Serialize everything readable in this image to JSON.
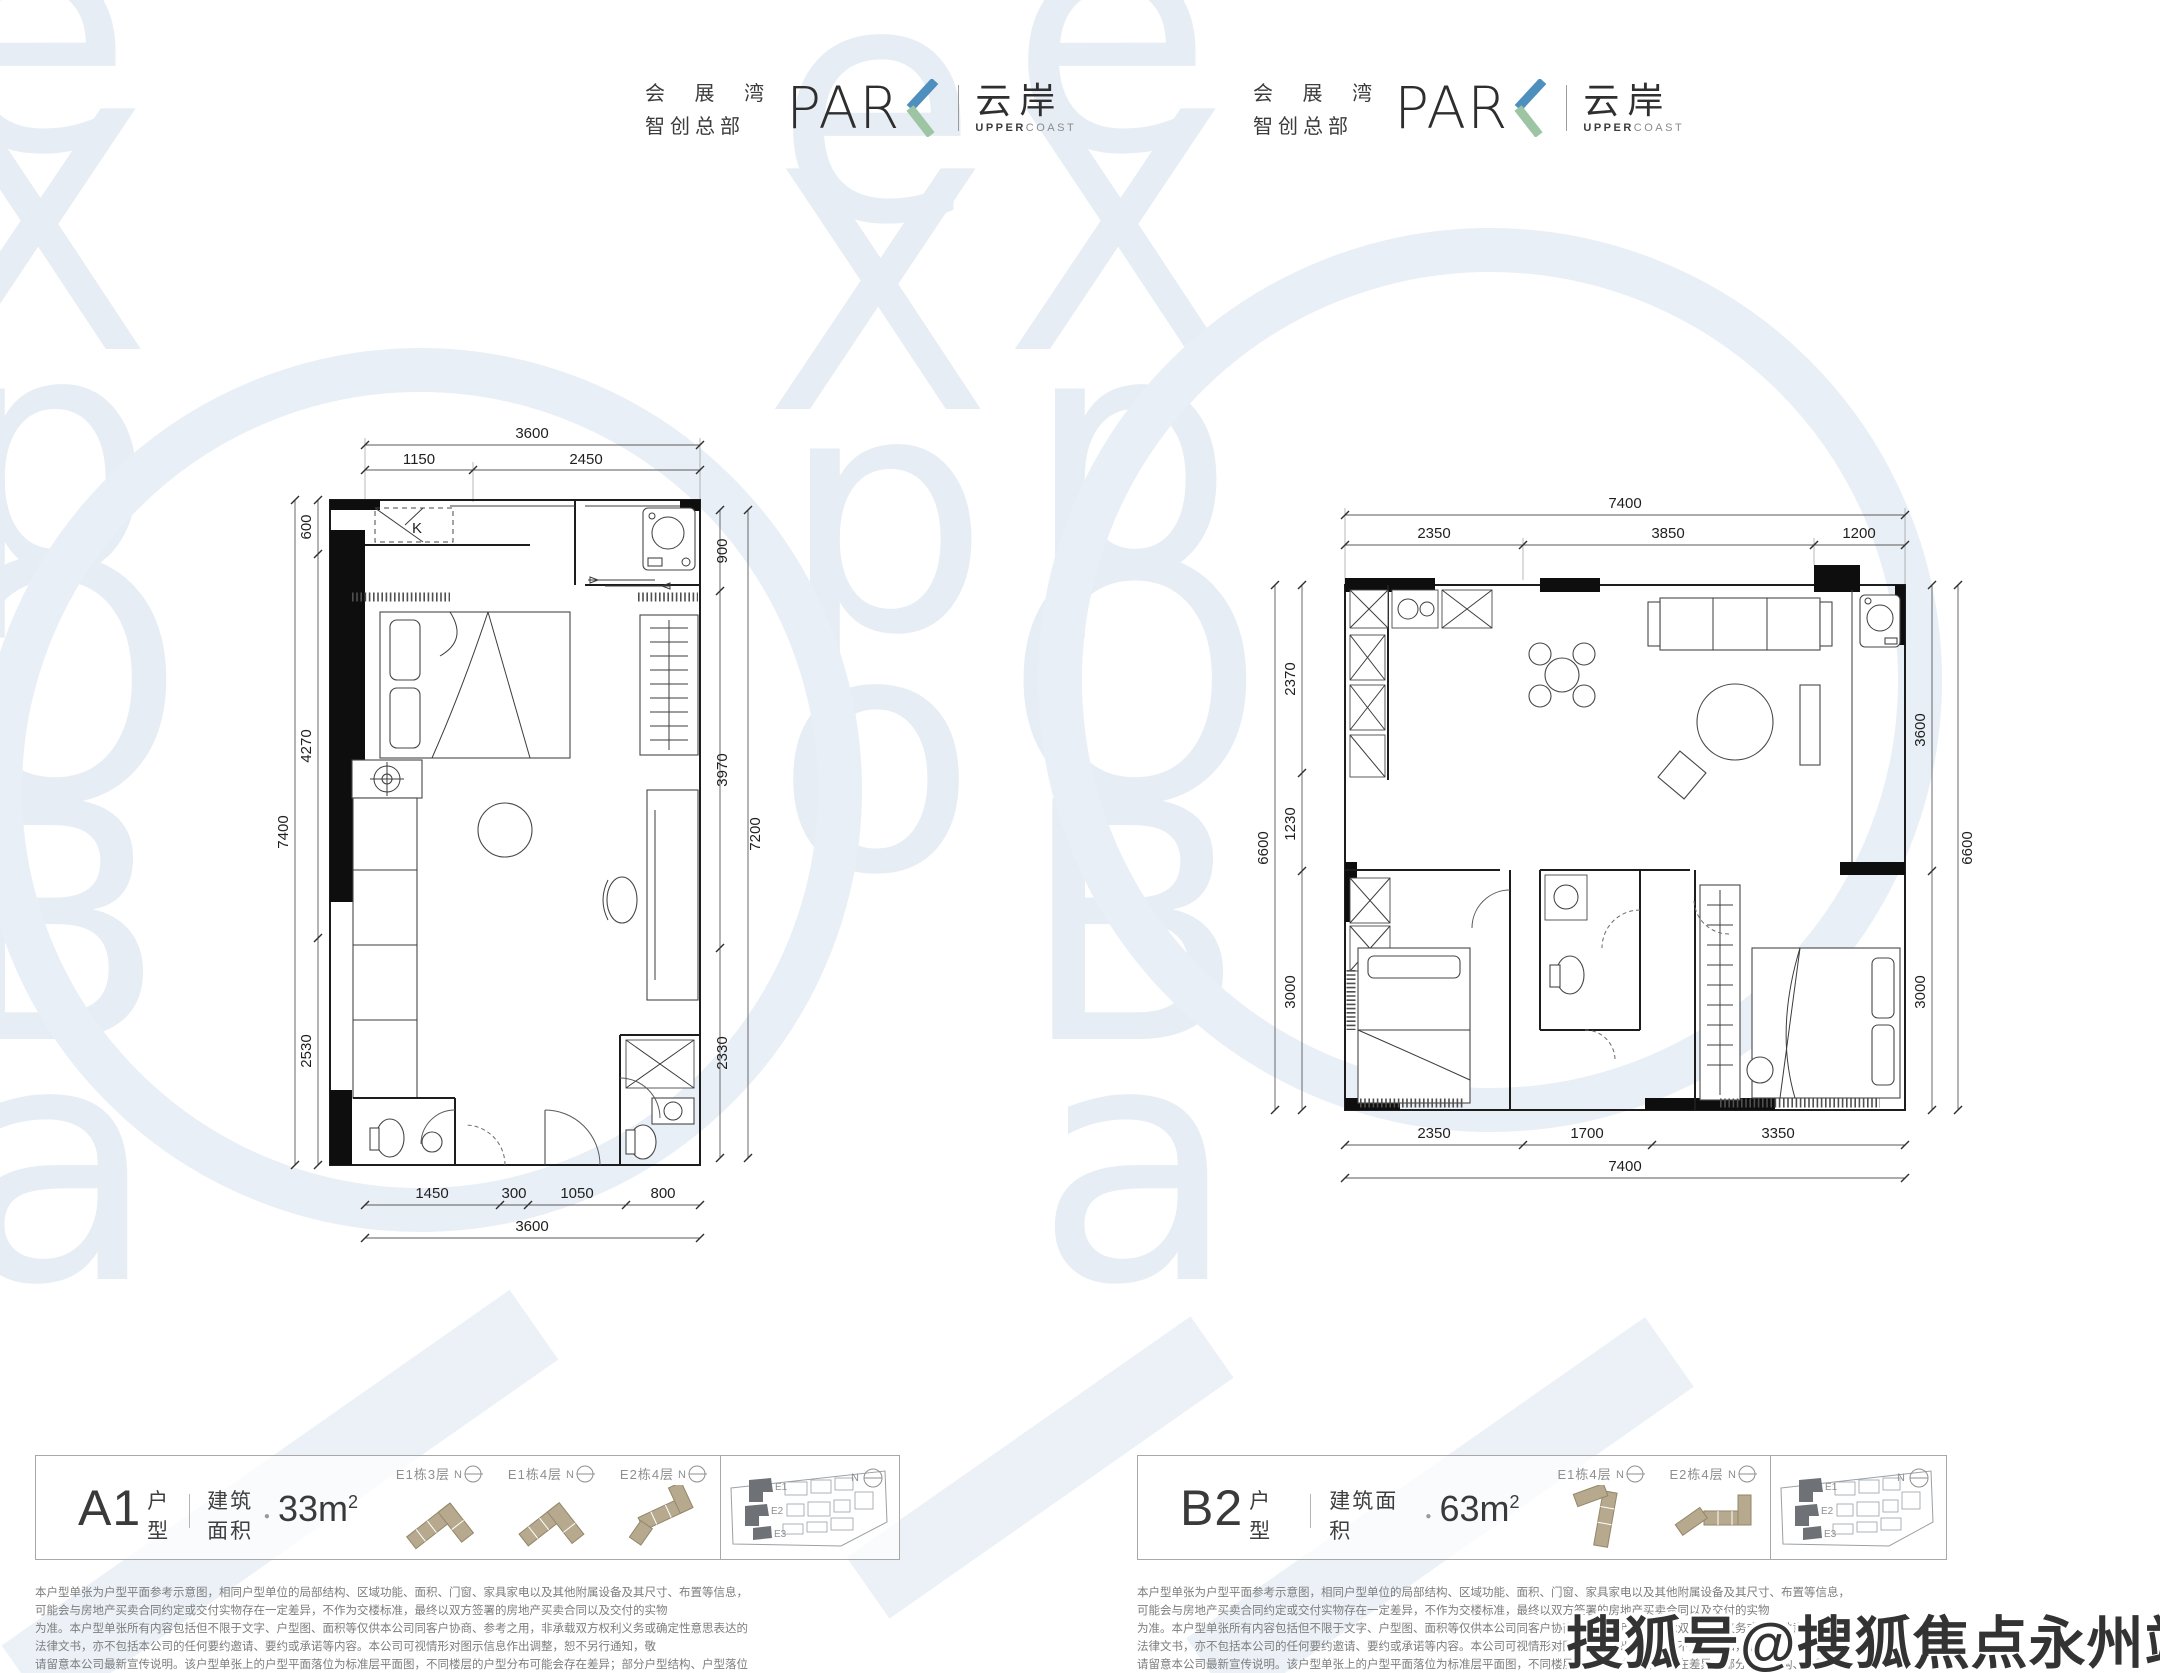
{
  "page": {
    "width": 2160,
    "height": 1673,
    "background": "#ffffff"
  },
  "brand": {
    "cn_top": "会 展 湾",
    "cn_bottom": "智创总部",
    "park_prefix": "PAR",
    "park_k": "K",
    "name_cn": "云岸",
    "name_en_bold": "UPPER",
    "name_en_light": "COAST",
    "k_blue": "#4e8fbe",
    "k_green": "#9dc5a3"
  },
  "labels": {
    "north": "N",
    "kitchen": "K"
  },
  "watermark": {
    "letters_col1": [
      "e",
      "X",
      "p",
      "O",
      "B",
      "a"
    ],
    "letters_col2": [
      "e",
      "X",
      "p",
      "o"
    ],
    "color": "#e6edf4",
    "sohu": "搜狐号@搜狐焦点永州站"
  },
  "plans": {
    "a1": {
      "dims_top": {
        "overall": "3600",
        "seg1": "1150",
        "seg2": "2450"
      },
      "dims_left": {
        "overall": "7400",
        "seg1": "600",
        "seg2": "4270",
        "seg3": "2530"
      },
      "dims_right": {
        "overall": "7200",
        "seg1": "900",
        "seg2": "3970",
        "seg3": "2330"
      },
      "dims_bottom": {
        "overall": "3600",
        "seg1": "1450",
        "seg2": "300",
        "seg3": "1050",
        "seg4": "800"
      }
    },
    "b2": {
      "dims_top": {
        "overall": "7400",
        "seg1": "2350",
        "seg2": "3850",
        "seg3": "1200"
      },
      "dims_left": {
        "overall": "6600",
        "seg1": "2370",
        "seg2": "1230",
        "seg3": "3000"
      },
      "dims_right": {
        "overall": "6600",
        "seg1": "3600",
        "seg2": "3000"
      },
      "dims_bottom": {
        "overall": "7400",
        "seg1": "2350",
        "seg2": "1700",
        "seg3": "3350"
      }
    }
  },
  "info_bars": {
    "a1": {
      "unit": "A1",
      "unit_suffix": "户型",
      "area_label": "建筑面积",
      "area_value": "33m",
      "area_sup": "2",
      "diagrams": [
        {
          "label": "E1栋3层"
        },
        {
          "label": "E1栋4层"
        },
        {
          "label": "E2栋4层"
        }
      ],
      "site_labels": [
        "E1",
        "E2",
        "E3"
      ]
    },
    "b2": {
      "unit": "B2",
      "unit_suffix": "户型",
      "area_label": "建筑面积",
      "area_value": "63m",
      "area_sup": "2",
      "diagrams": [
        {
          "label": "E1栋4层"
        },
        {
          "label": "E2栋4层"
        }
      ],
      "site_labels": [
        "E1",
        "E2",
        "E3"
      ]
    }
  },
  "disclaimer": {
    "line1": "本户型单张为户型平面参考示意图，相同户型单位的局部结构、区域功能、面积、门窗、家具家电以及其他附属设备及其尺寸、布置等信息，可能会与房地产买卖合同约定或交付实物存在一定差异，不作为交楼标准，最终以双方签署的房地产买卖合同以及交付的实物",
    "line2": "为准。本户型单张所有内容包括但不限于文字、户型图、面积等仅供本公司同客户协商、参考之用，非承载双方权利义务或确定性意思表达的法律文书，亦不包括本公司的任何要约邀请、要约或承诺等内容。本公司可视情形对图示信息作出调整，恕不另行通知，敬",
    "line3": "请留意本公司最新宣传说明。该户型单张上的户型平面落位为标准层平面图，不同楼层的户型分布可能会存在差异；部分户型结构、户型落位为镜像关系，敬请留意。印刷日期：2021年6月。"
  }
}
